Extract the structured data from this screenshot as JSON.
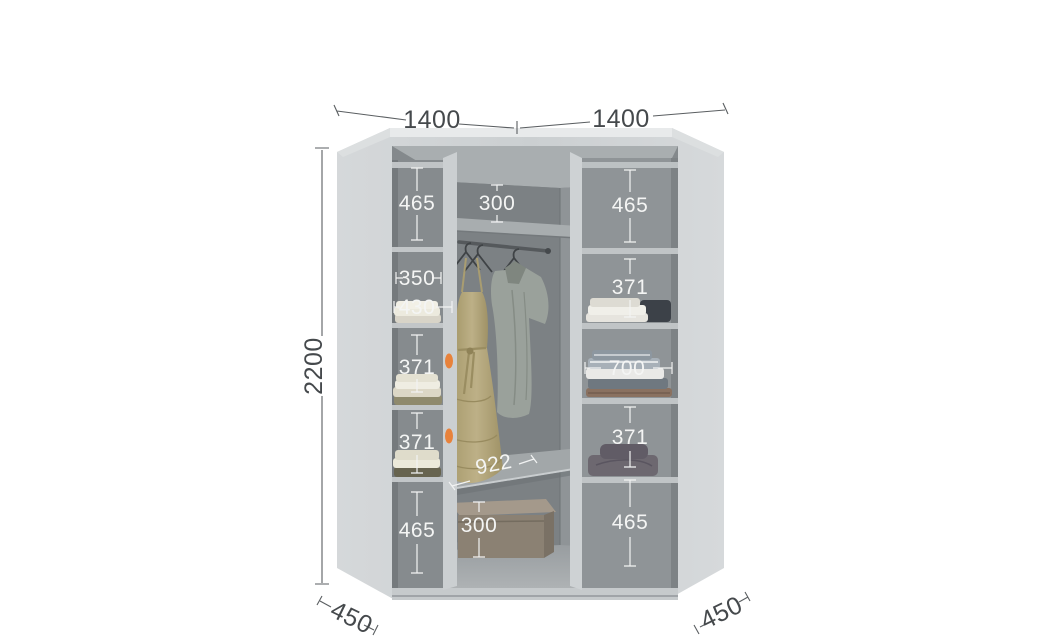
{
  "diagram_title": "corner-wardrobe-interior-dimensions",
  "outer": {
    "width_left": "1400",
    "width_right": "1400",
    "height": "2200",
    "depth_left": "450",
    "depth_right": "450"
  },
  "left_column": {
    "top_height": "465",
    "width_inner": "350",
    "width_outer": "430",
    "middle_height": "371",
    "lower_height": "371",
    "bottom_height": "465"
  },
  "center": {
    "top_gap": "300",
    "shelf_width": "922",
    "bottom_gap": "300"
  },
  "right_column": {
    "top_height": "465",
    "upper_height": "371",
    "width": "700",
    "lower_height": "371",
    "bottom_height": "465"
  },
  "colors": {
    "accent_orange": "#e8823b",
    "body_grey": "#ced2d4",
    "interior_grey": "#8b9093",
    "dimension_text_inner": "#f4f5f4",
    "dimension_text_outer": "#45494c"
  }
}
